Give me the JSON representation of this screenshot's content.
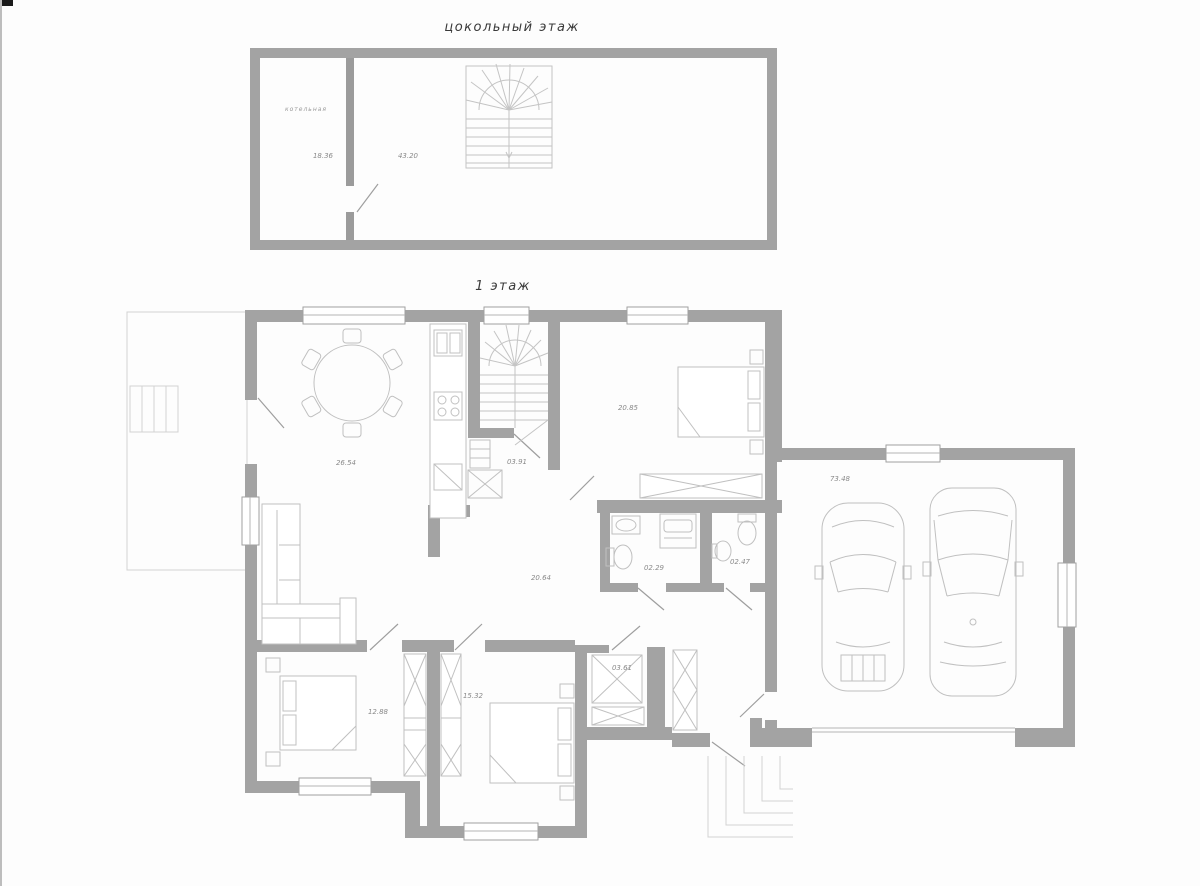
{
  "titles": {
    "basement": "цокольный этаж",
    "first": "1 этаж"
  },
  "basement": {
    "rooms": [
      {
        "id": "boiler-room",
        "name": "котельная",
        "area": "18.36"
      },
      {
        "id": "basement-hall",
        "area": "43.20"
      }
    ]
  },
  "first_floor": {
    "rooms": [
      {
        "id": "living-dining",
        "area": "26.54"
      },
      {
        "id": "pantry",
        "area": "03.91"
      },
      {
        "id": "bedroom-top",
        "area": "20.85"
      },
      {
        "id": "hall",
        "area": "20.64"
      },
      {
        "id": "wc-left",
        "area": "02.29"
      },
      {
        "id": "wc-right",
        "area": "02.47"
      },
      {
        "id": "bedroom-left",
        "area": "12.88"
      },
      {
        "id": "bedroom-middle",
        "area": "15.32"
      },
      {
        "id": "wardrobe-room",
        "area": "03.61"
      },
      {
        "id": "garage",
        "area": "73.48"
      }
    ]
  },
  "colors": {
    "wall": "#a3a3a3",
    "furniture": "#c0c0c0",
    "label_text": "#8a8a8a",
    "title_text": "#3a3a3a"
  }
}
